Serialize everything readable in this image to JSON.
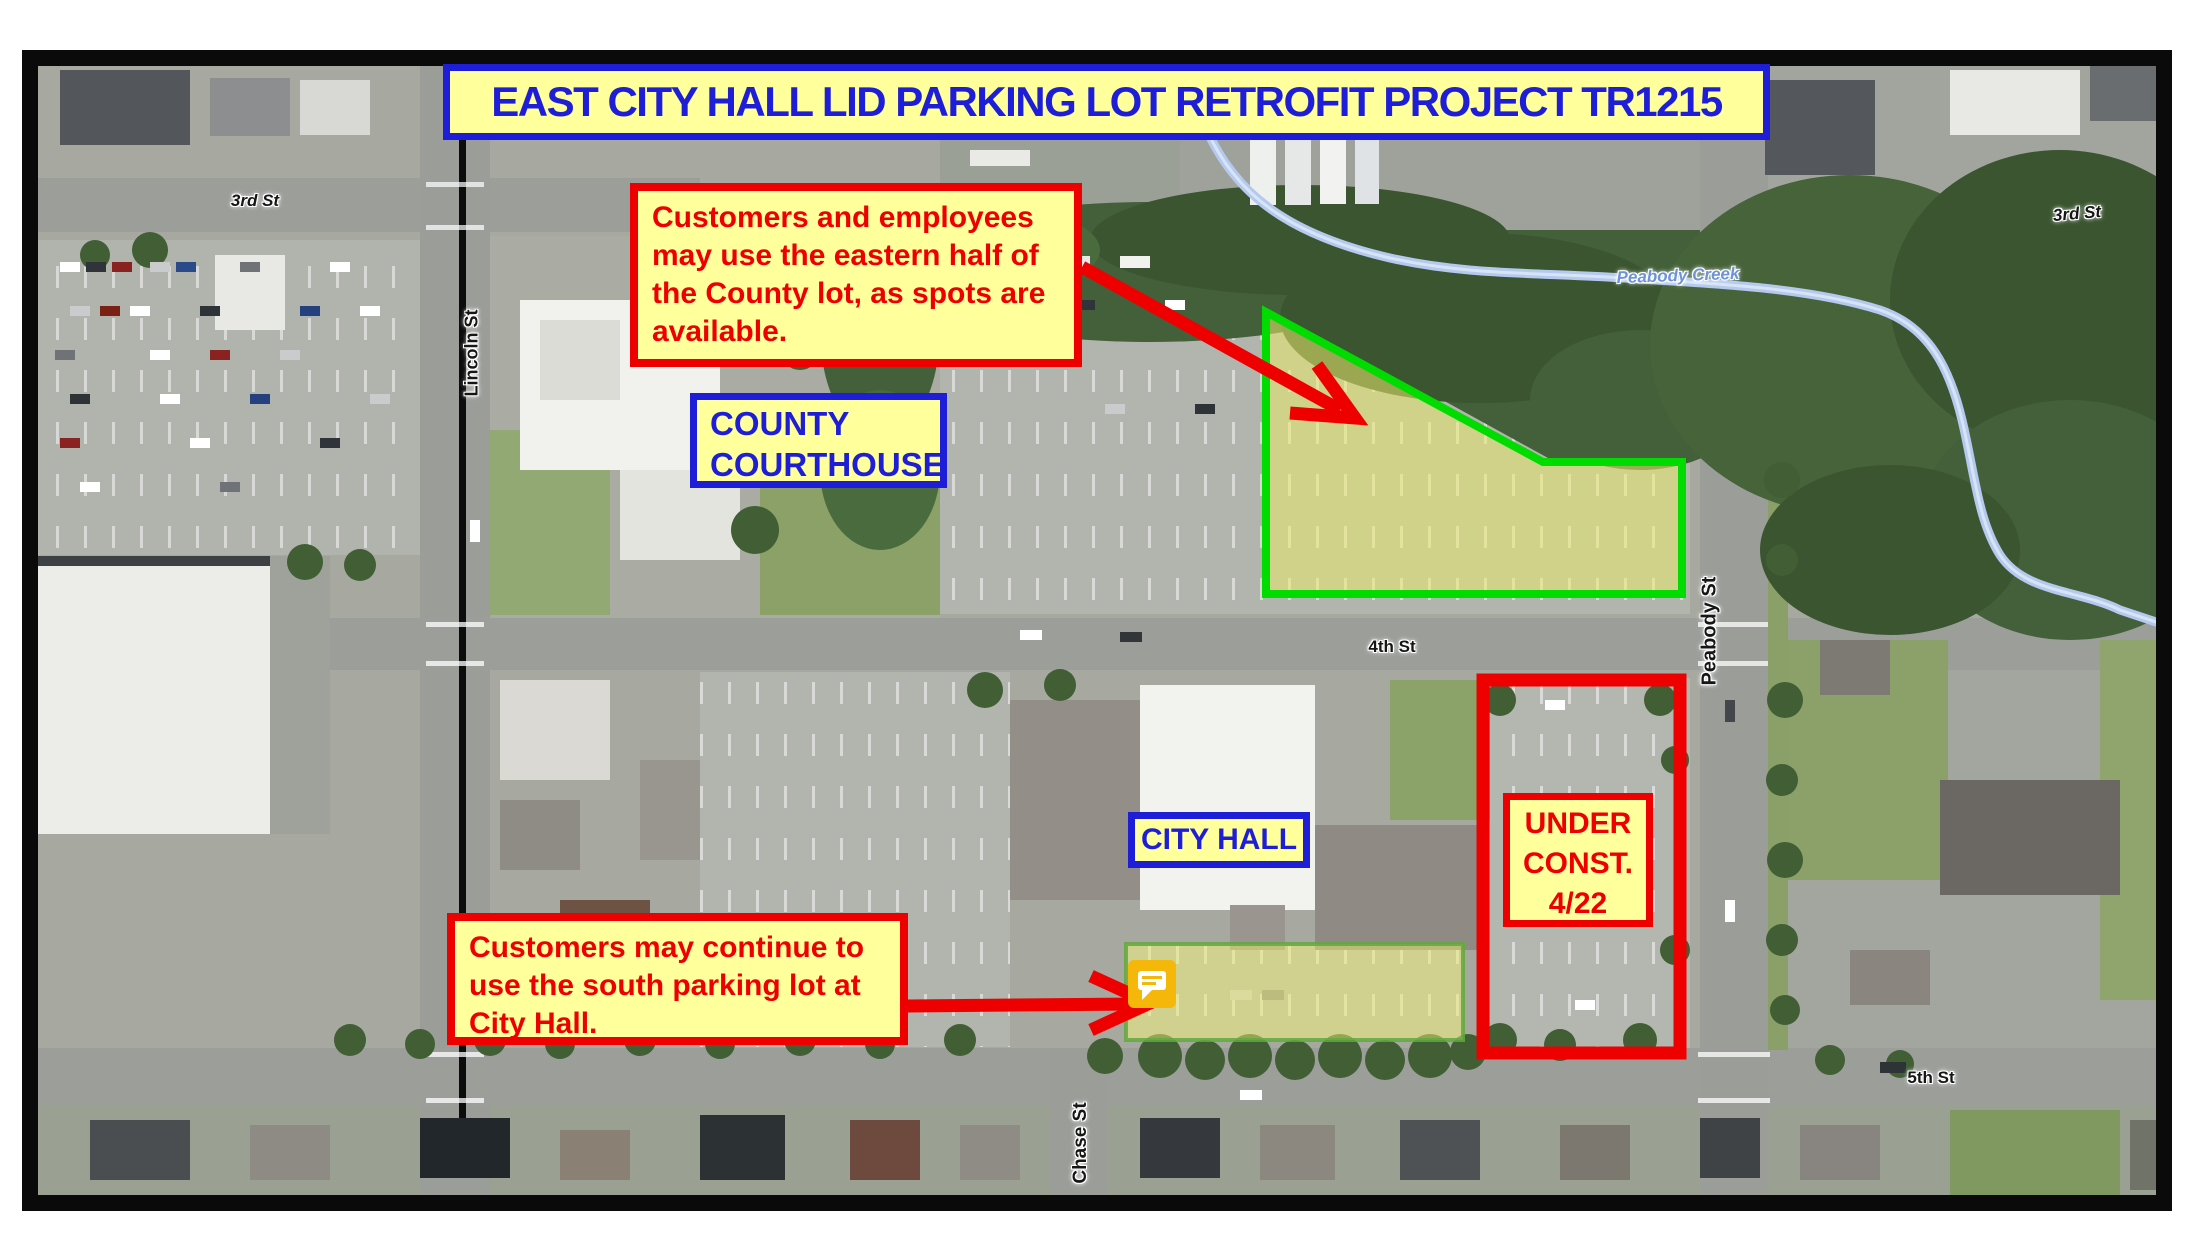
{
  "title_banner": {
    "text": "EAST CITY HALL LID PARKING LOT RETROFIT PROJECT TR1215"
  },
  "callouts": {
    "county_lot": {
      "line1": "Customers and employees",
      "line2": "may use the eastern half of",
      "line3": "the County lot, as spots are",
      "line4": "available."
    },
    "south_lot": {
      "line1": "Customers may continue to",
      "line2": "use the south parking lot at",
      "line3": "City Hall."
    }
  },
  "place_labels": {
    "county_courthouse": {
      "line1": "COUNTY",
      "line2": "COURTHOUSE"
    },
    "city_hall": "CITY HALL",
    "under_construction": {
      "line1": "UNDER",
      "line2": "CONST.",
      "line3": "4/22"
    }
  },
  "street_labels": {
    "third_st_west": "3rd St",
    "lincoln_st": "Lincoln St",
    "fourth_st": "4th St",
    "peabody_st": "Peabody St",
    "fifth_st": "5th St",
    "chase_st": "Chase St",
    "third_st_east": "3rd St"
  },
  "water_labels": {
    "peabody_creek": "Peabody Creek"
  },
  "colors": {
    "annotation_yellow": "#FFFF9C",
    "annotation_blue": "#1E1ED8",
    "annotation_red": "#EE0000",
    "county_highlight_stroke": "#00DC00",
    "south_highlight_stroke": "#62A93E",
    "creek": "#B4C9EE"
  }
}
